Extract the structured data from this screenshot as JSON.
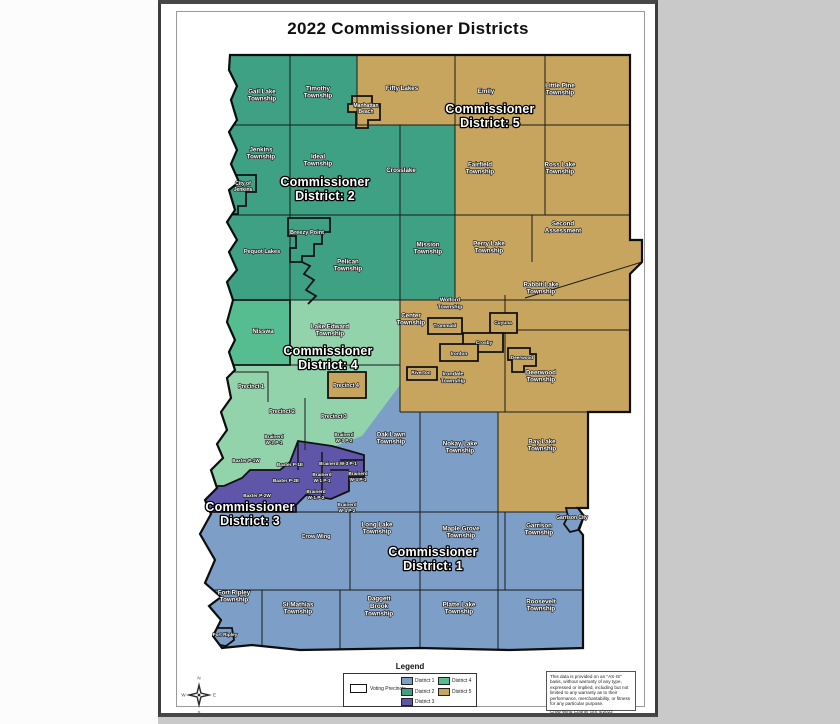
{
  "page": {
    "title": "2022 Commissioner Districts"
  },
  "colors": {
    "district1": "#7d9ec7",
    "district2": "#3ea183",
    "district3": "#5f55a9",
    "district4": "#56bd91",
    "district4_light": "#92d3ac",
    "district5": "#c8a55e",
    "boundary": "#141414"
  },
  "legend": {
    "title": "Legend",
    "voting_precincts_label": "Voting Precincts",
    "items": [
      {
        "label": "District 1"
      },
      {
        "label": "District 2"
      },
      {
        "label": "District 3"
      },
      {
        "label": "District 4"
      },
      {
        "label": "District 5"
      }
    ]
  },
  "compass": {
    "n": "N",
    "e": "E",
    "s": "S",
    "w": "W"
  },
  "disclaimer": {
    "text": "This data is provided on an \"AS-IS\" basis, without warranty of any type, expressed or implied, including but not limited to any warranty as to their performance, merchantability, or fitness for any particular purpose.",
    "credit": "Crow Wing County GIS 4/2022"
  },
  "map": {
    "district_labels": [
      {
        "t": "Commissioner\nDistrict: 5",
        "x": 490,
        "y": 120
      },
      {
        "t": "Commissioner\nDistrict: 2",
        "x": 325,
        "y": 193
      },
      {
        "t": "Commissioner\nDistrict: 4",
        "x": 328,
        "y": 362
      },
      {
        "t": "Commissioner\nDistrict: 3",
        "x": 250,
        "y": 518
      },
      {
        "t": "Commissioner\nDistrict: 1",
        "x": 433,
        "y": 563
      }
    ],
    "labels": [
      {
        "t": "Gail Lake\nTownship",
        "x": 262,
        "y": 97
      },
      {
        "t": "Timothy\nTownship",
        "x": 318,
        "y": 94
      },
      {
        "t": "Fifty Lakes",
        "x": 402,
        "y": 90
      },
      {
        "t": "Manhattan\nBeach",
        "x": 366,
        "y": 110,
        "s": 5
      },
      {
        "t": "Emily",
        "x": 486,
        "y": 93
      },
      {
        "t": "Little Pine\nTownship",
        "x": 560,
        "y": 91
      },
      {
        "t": "Jenkins\nTownship",
        "x": 261,
        "y": 155
      },
      {
        "t": "City of\nJenkins",
        "x": 243,
        "y": 188,
        "s": 5
      },
      {
        "t": "Ideal\nTownship",
        "x": 318,
        "y": 162
      },
      {
        "t": "Crosslake",
        "x": 401,
        "y": 172
      },
      {
        "t": "Fairfield\nTownship",
        "x": 480,
        "y": 170
      },
      {
        "t": "Ross Lake\nTownship",
        "x": 560,
        "y": 170
      },
      {
        "t": "Pequot Lakes",
        "x": 262,
        "y": 253,
        "s": 5.6
      },
      {
        "t": "Breezy Point",
        "x": 307,
        "y": 234,
        "s": 5.6
      },
      {
        "t": "Pelican\nTownship",
        "x": 348,
        "y": 267
      },
      {
        "t": "Mission\nTownship",
        "x": 428,
        "y": 250
      },
      {
        "t": "Perry Lake\nTownship",
        "x": 489,
        "y": 249
      },
      {
        "t": "Second\nAssessment",
        "x": 563,
        "y": 229
      },
      {
        "t": "Rabbit Lake\nTownship",
        "x": 541,
        "y": 290
      },
      {
        "t": "Nisswa",
        "x": 263,
        "y": 333
      },
      {
        "t": "Lake Edward\nTownship",
        "x": 330,
        "y": 332
      },
      {
        "t": "Center\nTownship",
        "x": 411,
        "y": 321
      },
      {
        "t": "Wolford\nTownship",
        "x": 450,
        "y": 305,
        "s": 5.4
      },
      {
        "t": "Trommald",
        "x": 445,
        "y": 327,
        "s": 4.8
      },
      {
        "t": "Cuyuna",
        "x": 503,
        "y": 324,
        "s": 4.8
      },
      {
        "t": "Crosby",
        "x": 484,
        "y": 344,
        "s": 4.8
      },
      {
        "t": "Ironton",
        "x": 459,
        "y": 355,
        "s": 4.8
      },
      {
        "t": "Riverton",
        "x": 421,
        "y": 374,
        "s": 4.8
      },
      {
        "t": "Irondale\nTownship",
        "x": 453,
        "y": 379,
        "s": 5.4
      },
      {
        "t": "Deerwood",
        "x": 522,
        "y": 359,
        "s": 4.6
      },
      {
        "t": "Deerwood\nTownship",
        "x": 541,
        "y": 378
      },
      {
        "t": "Precinct 1",
        "x": 251,
        "y": 388,
        "s": 5.4
      },
      {
        "t": "Precinct 2",
        "x": 282,
        "y": 413,
        "s": 5.4
      },
      {
        "t": "Precinct 3",
        "x": 334,
        "y": 418,
        "s": 5.4
      },
      {
        "t": "Precinct 4",
        "x": 346,
        "y": 387,
        "s": 5.4
      },
      {
        "t": "Oak Lawn\nTownship",
        "x": 391,
        "y": 440
      },
      {
        "t": "Nokay Lake\nTownship",
        "x": 460,
        "y": 449
      },
      {
        "t": "Bay Lake\nTownship",
        "x": 542,
        "y": 447
      },
      {
        "t": "Brainerd\nW-2 P-1",
        "x": 274,
        "y": 441,
        "s": 4.7
      },
      {
        "t": "Brainerd\nW-3 P-2",
        "x": 344,
        "y": 439,
        "s": 4.7
      },
      {
        "t": "Baxter P-1W",
        "x": 246,
        "y": 462,
        "s": 4.7
      },
      {
        "t": "Baxter P-1E",
        "x": 290,
        "y": 466,
        "s": 4.7
      },
      {
        "t": "Brainerd W-3 P-1",
        "x": 338,
        "y": 465,
        "s": 4.7
      },
      {
        "t": "Brainerd\nW-1 P-1",
        "x": 322,
        "y": 479,
        "s": 4.7
      },
      {
        "t": "Brainerd\nW-4 P-1",
        "x": 358,
        "y": 478,
        "s": 4.7
      },
      {
        "t": "Baxter P-2E",
        "x": 286,
        "y": 482,
        "s": 4.7
      },
      {
        "t": "Brainerd\nW-1 P-2",
        "x": 316,
        "y": 496,
        "s": 4.7
      },
      {
        "t": "Baxter P-2W",
        "x": 257,
        "y": 497,
        "s": 4.7
      },
      {
        "t": "Brainerd\nW-4 P-2",
        "x": 347,
        "y": 509,
        "s": 4.7
      },
      {
        "t": "Crow Wing",
        "x": 316,
        "y": 538,
        "s": 5.6
      },
      {
        "t": "Long Lake\nTownship",
        "x": 377,
        "y": 530
      },
      {
        "t": "Maple Grove\nTownship",
        "x": 461,
        "y": 534
      },
      {
        "t": "Garrison\nTownship",
        "x": 539,
        "y": 531
      },
      {
        "t": "Garrison City",
        "x": 572,
        "y": 519,
        "s": 5
      },
      {
        "t": "Fort Ripley\nTownship",
        "x": 234,
        "y": 598
      },
      {
        "t": "St Mathias\nTownship",
        "x": 298,
        "y": 610
      },
      {
        "t": "Daggett\nBrook\nTownship",
        "x": 379,
        "y": 608
      },
      {
        "t": "Platte Lake\nTownship",
        "x": 459,
        "y": 610
      },
      {
        "t": "Roosevelt\nTownship",
        "x": 541,
        "y": 607
      },
      {
        "t": "Fort Ripley",
        "x": 225,
        "y": 636,
        "s": 4.7
      }
    ]
  }
}
